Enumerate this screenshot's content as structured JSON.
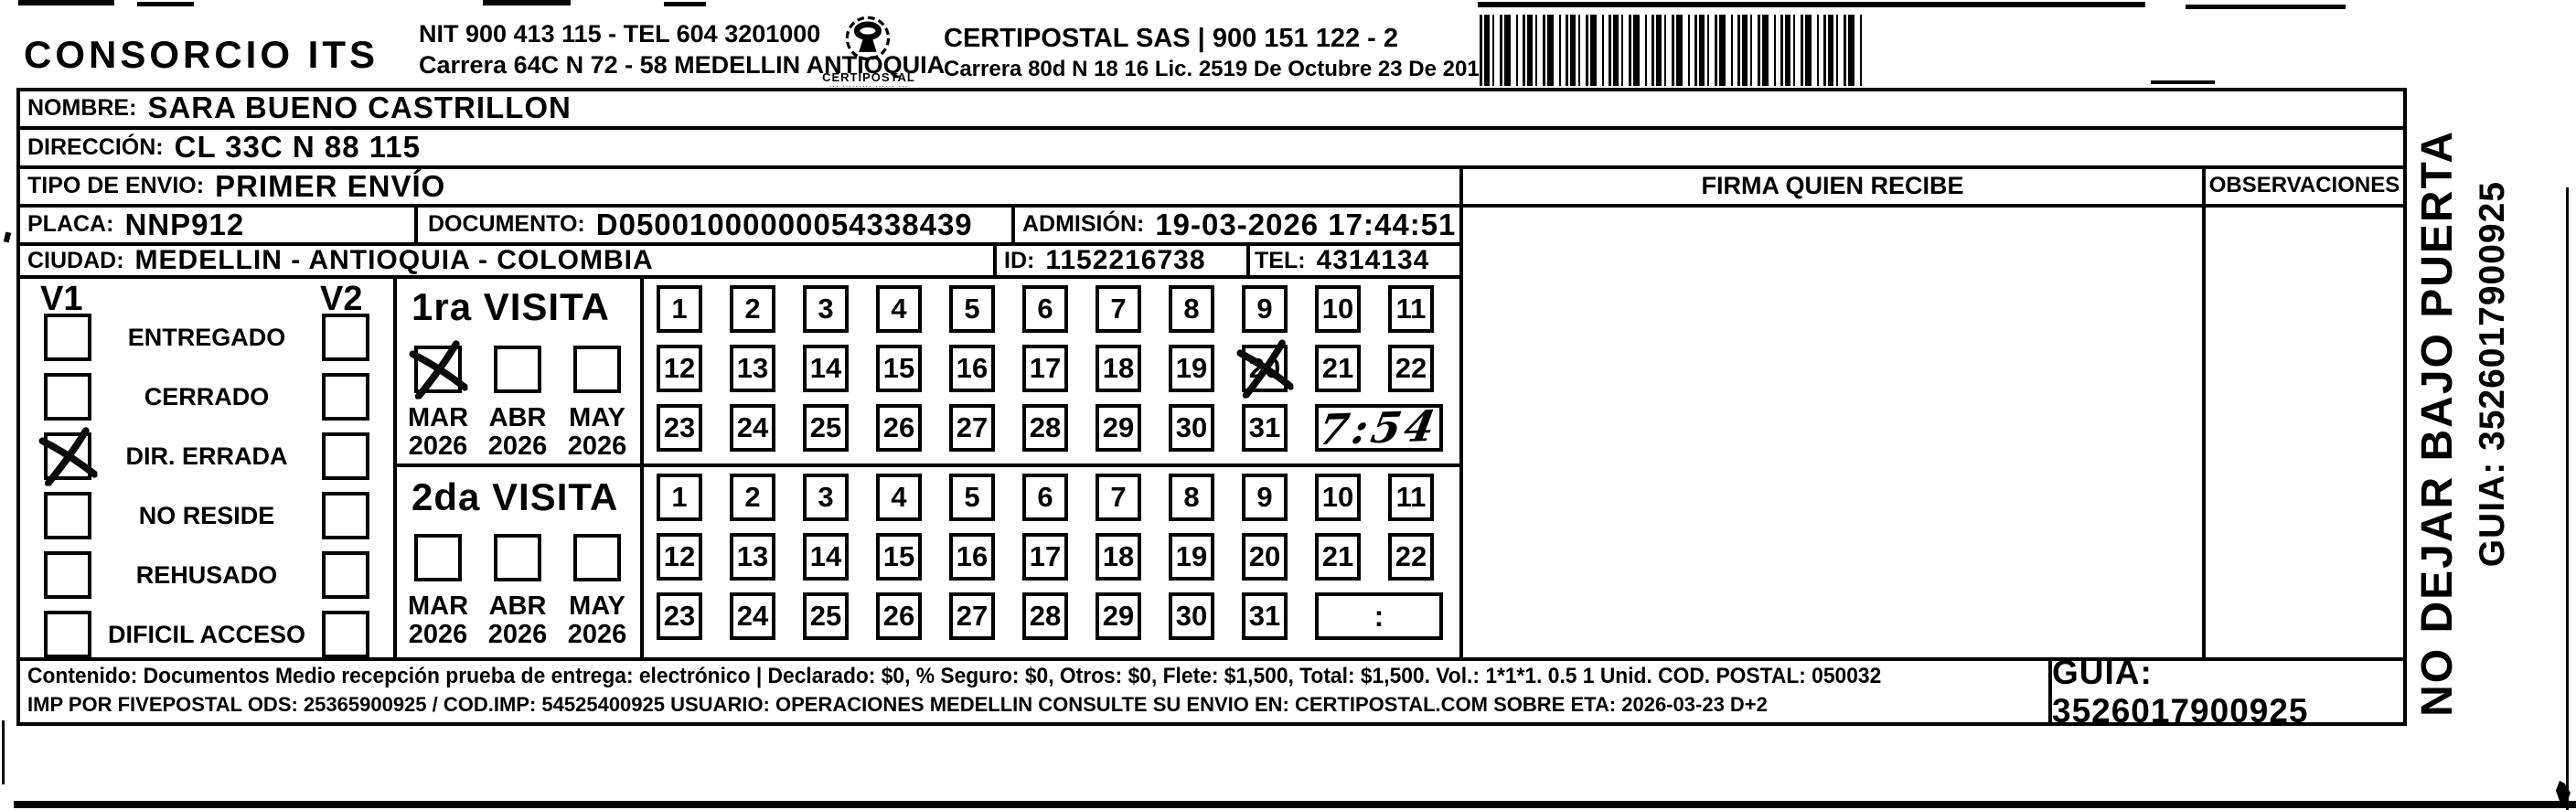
{
  "header": {
    "company": "CONSORCIO ITS",
    "nit_tel": "NIT 900 413 115 - TEL 604 3201000",
    "address": "Carrera 64C N 72 - 58 MEDELLIN ANTIOQUIA",
    "logo_caption": "CERTIPOSTAL",
    "logo_subcaption": "··· ········· ······ ···",
    "entity_line": "CERTIPOSTAL SAS | 900 151 122 - 2",
    "license_line": "Carrera 80d N 18 16  Lic. 2519 De Octubre 23 De 2015"
  },
  "recipient": {
    "nombre_label": "NOMBRE:",
    "nombre": "SARA BUENO CASTRILLON",
    "direccion_label": "DIRECCIÓN:",
    "direccion": "CL 33C N 88 115",
    "tipo_label": "TIPO DE ENVIO:",
    "tipo": "PRIMER ENVÍO",
    "placa_label": "PLACA:",
    "placa": "NNP912",
    "documento_label": "DOCUMENTO:",
    "documento": "D05001000000054338439",
    "admision_label": "ADMISIÓN:",
    "admision": "19-03-2026 17:44:51",
    "ciudad_label": "CIUDAD:",
    "ciudad": "MEDELLIN - ANTIOQUIA - COLOMBIA",
    "id_label": "ID:",
    "id": "1152216738",
    "tel_label": "TEL:",
    "tel": "4314134"
  },
  "columns": {
    "firma": "FIRMA QUIEN RECIBE",
    "observaciones": "OBSERVACIONES"
  },
  "status": {
    "v1_label": "V1",
    "v2_label": "V2",
    "items": [
      {
        "label": "ENTREGADO",
        "v1_checked": false,
        "v2_checked": false
      },
      {
        "label": "CERRADO",
        "v1_checked": false,
        "v2_checked": false
      },
      {
        "label": "DIR. ERRADA",
        "v1_checked": true,
        "v2_checked": false
      },
      {
        "label": "NO RESIDE",
        "v1_checked": false,
        "v2_checked": false
      },
      {
        "label": "REHUSADO",
        "v1_checked": false,
        "v2_checked": false
      },
      {
        "label": "DIFICIL ACCESO",
        "v1_checked": false,
        "v2_checked": false
      }
    ]
  },
  "visits": [
    {
      "title": "1ra VISITA",
      "months": [
        {
          "label": "MAR",
          "year": "2026",
          "checked": true
        },
        {
          "label": "ABR",
          "year": "2026",
          "checked": false
        },
        {
          "label": "MAY",
          "year": "2026",
          "checked": false
        }
      ],
      "day_rows": [
        [
          1,
          2,
          3,
          4,
          5,
          6,
          7,
          8,
          9,
          10,
          11
        ],
        [
          12,
          13,
          14,
          15,
          16,
          17,
          18,
          19,
          20,
          21,
          22
        ],
        [
          23,
          24,
          25,
          26,
          27,
          28,
          29,
          30,
          31
        ]
      ],
      "crossed_day": 20,
      "time": "7:54",
      "time_style": "handwritten"
    },
    {
      "title": "2da VISITA",
      "months": [
        {
          "label": "MAR",
          "year": "2026",
          "checked": false
        },
        {
          "label": "ABR",
          "year": "2026",
          "checked": false
        },
        {
          "label": "MAY",
          "year": "2026",
          "checked": false
        }
      ],
      "day_rows": [
        [
          1,
          2,
          3,
          4,
          5,
          6,
          7,
          8,
          9,
          10,
          11
        ],
        [
          12,
          13,
          14,
          15,
          16,
          17,
          18,
          19,
          20,
          21,
          22
        ],
        [
          23,
          24,
          25,
          26,
          27,
          28,
          29,
          30,
          31
        ]
      ],
      "crossed_day": null,
      "time": ":",
      "time_style": "printed"
    }
  ],
  "side_note": {
    "line1": "NO DEJAR BAJO PUERTA",
    "line2": "GUIA: 3526017900925"
  },
  "footer": {
    "content_line": "Contenido: Documentos Medio recepción prueba de entrega: electrónico | Declarado: $0, % Seguro: $0, Otros: $0, Flete: $1,500, Total: $1,500. Vol.: 1*1*1. 0.5  1 Unid. COD. POSTAL: 050032",
    "imp_line": "IMP POR FIVEPOSTAL ODS: 25365900925 / COD.IMP: 54525400925 USUARIO: OPERACIONES MEDELLIN CONSULTE SU ENVIO EN: CERTIPOSTAL.COM SOBRE ETA: 2026-03-23 D+2",
    "guia": "GUIA: 3526017900925"
  },
  "colors": {
    "ink": "#000000",
    "paper": "#ffffff"
  }
}
